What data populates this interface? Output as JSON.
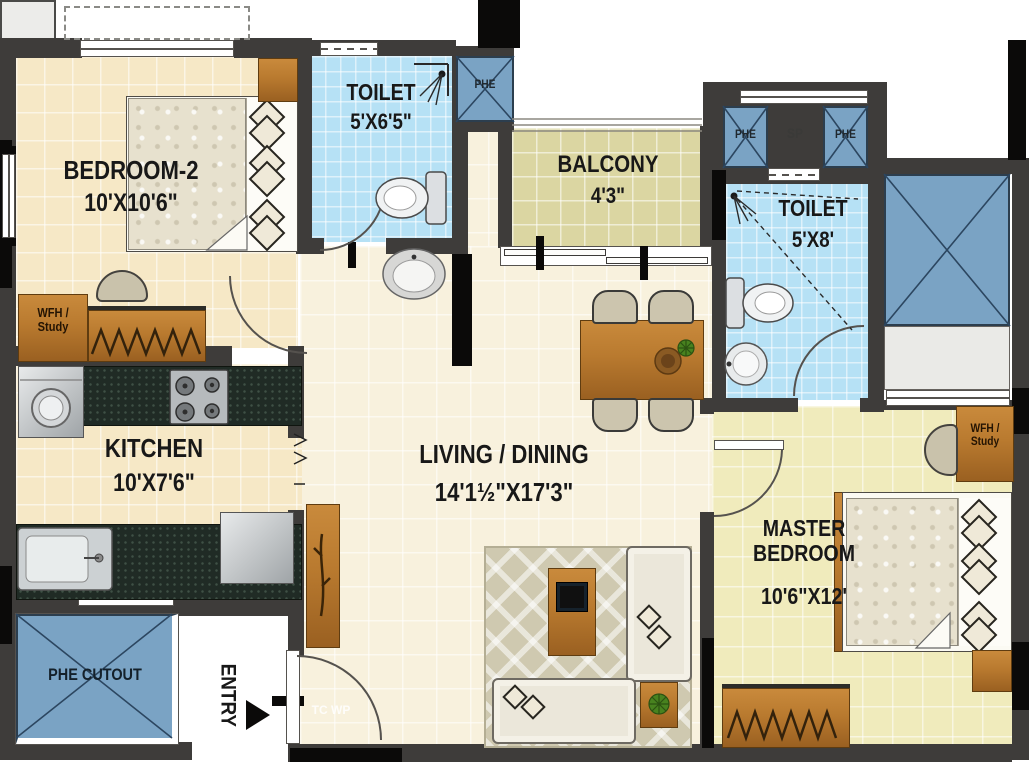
{
  "title": "2BHK Apartment Floor Plan",
  "colors": {
    "wall": "#3e3c3a",
    "black": "#0b0a09",
    "beige": "#f6e8c6",
    "cream": "#f8f1dd",
    "masterfloor": "#f0ebbc",
    "balconyfloor": "#dbd6a2",
    "toiletfloor": "#b6e1f5",
    "shaft": "#7aa3c4",
    "sp": "#ececea",
    "wood": "#b97a2f",
    "counter": "#202b25",
    "label": "#181818"
  },
  "rooms": {
    "bedroom2": {
      "name": "BEDROOM-2",
      "dims": "10'X10'6\""
    },
    "toilet1": {
      "name": "TOILET",
      "dims": "5'X6'5\""
    },
    "balcony": {
      "name": "BALCONY",
      "dims": "4'3\""
    },
    "toilet2": {
      "name": "TOILET",
      "dims": "5'X8'"
    },
    "kitchen": {
      "name": "KITCHEN",
      "dims": "10'X7'6\""
    },
    "living": {
      "name": "LIVING / DINING",
      "dims": "14'1½\"X17'3\""
    },
    "master": {
      "name": "MASTER BEDROOM",
      "dims": "10'6\"X12'"
    }
  },
  "shafts": {
    "phe_top_left": "PHE",
    "phe_right_1": "PHE",
    "sp": "SP",
    "phe_right_2": "PHE",
    "phe_cutout": "PHE CUTOUT"
  },
  "labels": {
    "entry": "ENTRY",
    "wfh1_line1": "WFH /",
    "wfh1_line2": "Study",
    "wfh2_line1": "WFH /",
    "wfh2_line2": "Study",
    "watermark": "TC WP"
  }
}
